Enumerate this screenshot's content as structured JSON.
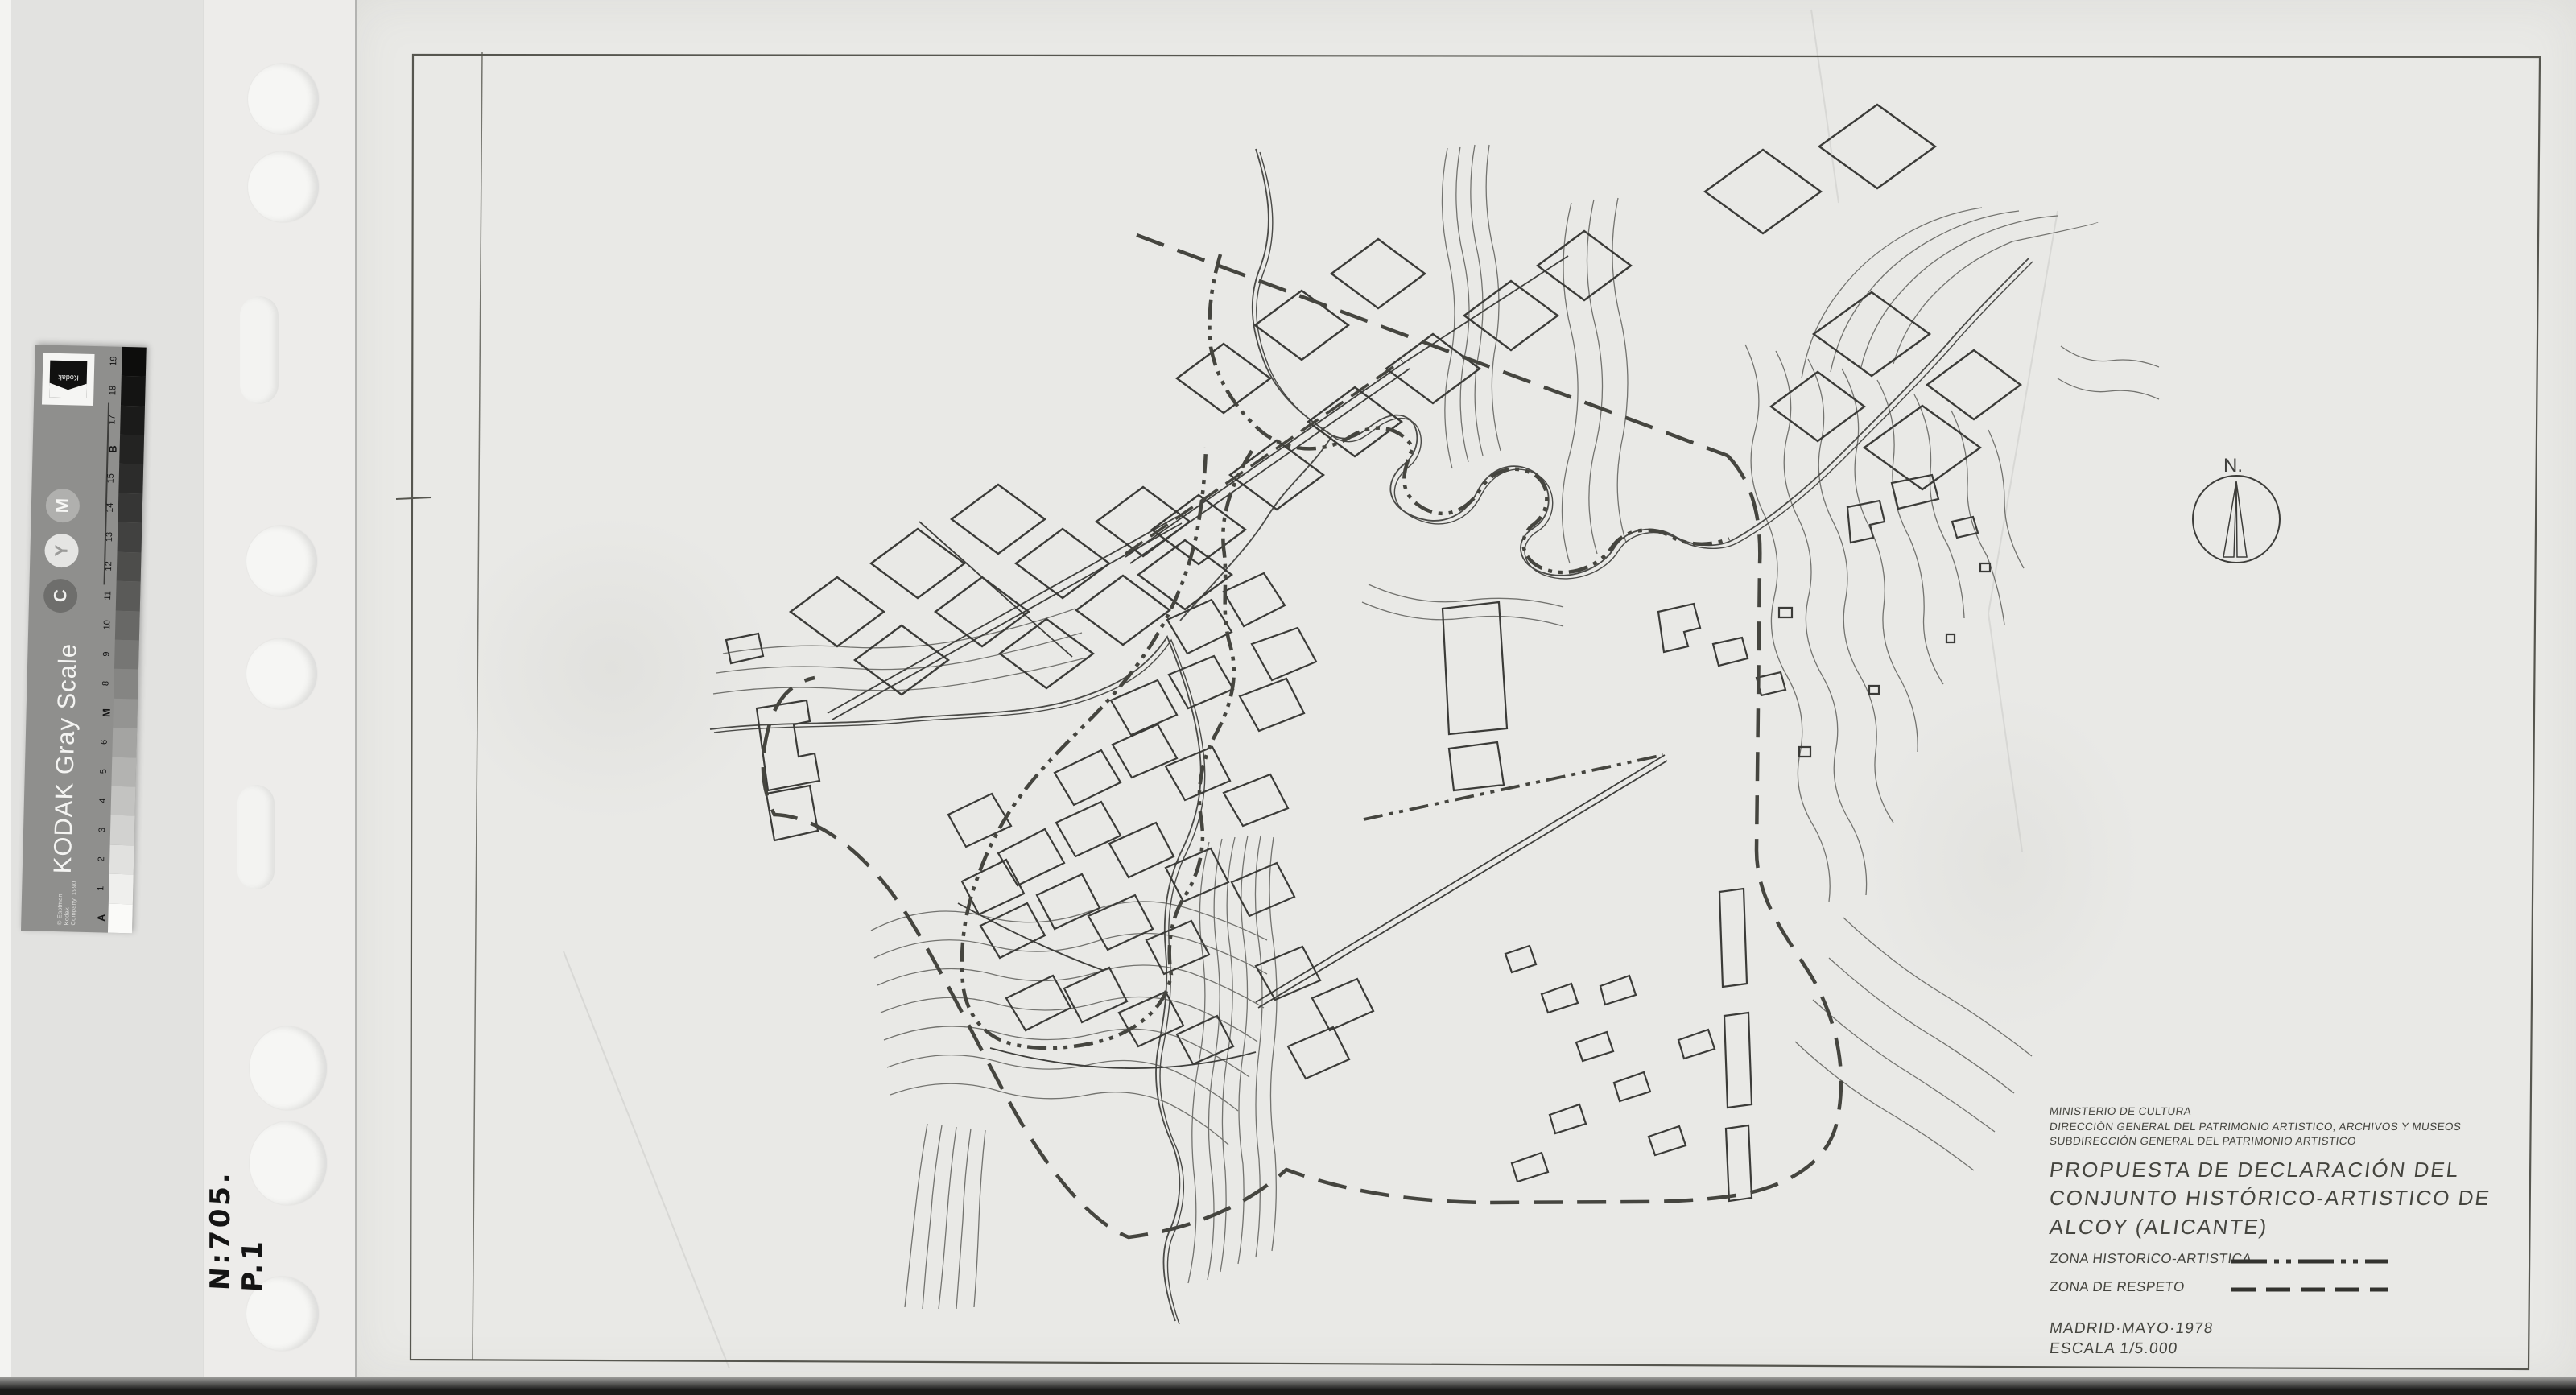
{
  "document": {
    "agency_lines": [
      "MINISTERIO DE CULTURA",
      "DIRECCIÓN GENERAL DEL PATRIMONIO ARTISTICO, ARCHIVOS Y MUSEOS",
      "SUBDIRECCIÓN GENERAL DEL PATRIMONIO ARTISTICO"
    ],
    "title_lines": [
      "PROPUESTA DE DECLARACIÓN DEL",
      "CONJUNTO HISTÓRICO-ARTISTICO DE",
      "ALCOY  (ALICANTE)"
    ],
    "legend": [
      {
        "label": "ZONA HISTORICO-ARTISTICA",
        "style": "dash-dot-dot"
      },
      {
        "label": "ZONA DE RESPETO",
        "style": "dashed"
      }
    ],
    "place_date": "MADRID·MAYO·1978",
    "scale": "ESCALA 1/5.000",
    "north_label": "N."
  },
  "annotations": {
    "handwritten_number": "N:705. P.1"
  },
  "kodak_strip": {
    "brand": "Kodak",
    "title": "KODAK Gray Scale",
    "copyright": "© Eastman Kodak Company, 1990",
    "cym": [
      {
        "letter": "C",
        "bg": "#6e6e6c",
        "fg": "#f1f1ef"
      },
      {
        "letter": "Y",
        "bg": "#e5e5e3",
        "fg": "#9b9b99"
      },
      {
        "letter": "M",
        "bg": "#b0b0ae",
        "fg": "#f6f6f4"
      }
    ],
    "patches": [
      {
        "label": "A",
        "bold": true,
        "color": "#fafaf8"
      },
      {
        "label": "1",
        "bold": false,
        "color": "#efefed"
      },
      {
        "label": "2",
        "bold": false,
        "color": "#e1e1df"
      },
      {
        "label": "3",
        "bold": false,
        "color": "#d2d2d0"
      },
      {
        "label": "4",
        "bold": false,
        "color": "#c3c3c1"
      },
      {
        "label": "5",
        "bold": false,
        "color": "#b3b3b1"
      },
      {
        "label": "6",
        "bold": false,
        "color": "#a4a4a2"
      },
      {
        "label": "M",
        "bold": true,
        "color": "#949492"
      },
      {
        "label": "8",
        "bold": false,
        "color": "#858583"
      },
      {
        "label": "9",
        "bold": false,
        "color": "#767674"
      },
      {
        "label": "10",
        "bold": false,
        "color": "#686866"
      },
      {
        "label": "11",
        "bold": false,
        "color": "#5a5a58"
      },
      {
        "label": "12",
        "bold": false,
        "color": "#4d4d4b"
      },
      {
        "label": "13",
        "bold": false,
        "color": "#414140"
      },
      {
        "label": "14",
        "bold": false,
        "color": "#363635"
      },
      {
        "label": "15",
        "bold": false,
        "color": "#2c2c2b"
      },
      {
        "label": "B",
        "bold": true,
        "color": "#232322"
      },
      {
        "label": "17",
        "bold": false,
        "color": "#1b1b1a"
      },
      {
        "label": "18",
        "bold": false,
        "color": "#141413"
      },
      {
        "label": "19",
        "bold": false,
        "color": "#0d0d0c"
      }
    ]
  },
  "colors": {
    "paper": "#e9e9e6",
    "scanner_background": "#e2e2e0",
    "ink": "#3b3b38",
    "contour": "#6d6d69"
  }
}
